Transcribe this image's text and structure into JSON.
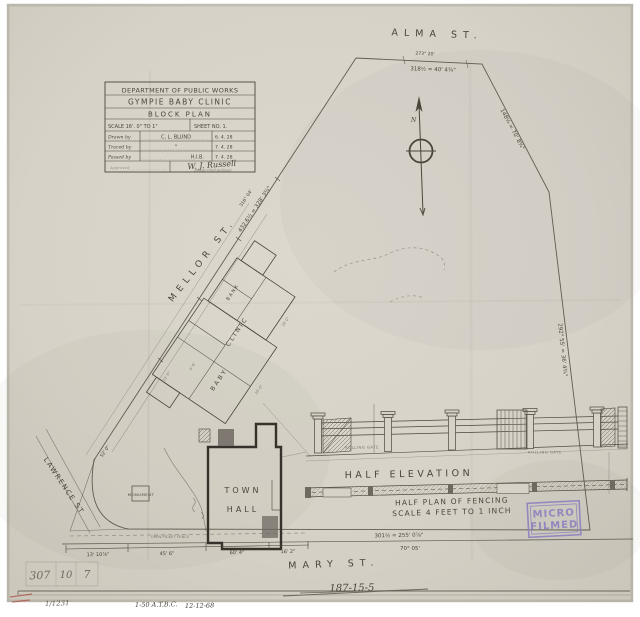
{
  "palette": {
    "paper": "#d7d3c9",
    "ink": "#4b463c",
    "pencil": "#847f74",
    "stamp_purple": "#8a7cc0",
    "red_mark": "#b0574f",
    "blue_pencil": "#7b84a0"
  },
  "title_block": {
    "dept": "DEPARTMENT OF PUBLIC WORKS",
    "project": "GYMPIE  BABY  CLINIC",
    "plan": "BLOCK  PLAN",
    "scale": "SCALE 16'. 0\" TO 1\"",
    "sheet": "SHEET NO. 1.",
    "rows": [
      {
        "label": "Drawn by",
        "value": "C. L. BLUND",
        "date": "6. 4. 28"
      },
      {
        "label": "Traced by",
        "value": "\"",
        "date": "7. 4. 28"
      },
      {
        "label": "Passed by",
        "value": "H.I.B.",
        "date": "7. 4. 28"
      }
    ],
    "approved_label": "Approved",
    "signature": "W. J. Russell",
    "signature_title": "Deputy Chief Architect"
  },
  "streets": {
    "alma": "ALMA  ST.",
    "mellor": "MELLOR  ST.",
    "lawrence": "LAWRENCE  ST",
    "mary": "MARY  ST."
  },
  "labels": {
    "town_1": "TOWN",
    "town_2": "HALL",
    "monument": "MONUMENT",
    "baby": "BABY",
    "clinic": "CLINIC",
    "bank": "BANK",
    "half_elevation": "HALF  ELEVATION",
    "half_plan": "HALF PLAN OF FENCING",
    "half_plan_scale": "SCALE 4 FEET TO 1 INCH",
    "rolling_gate_left": "ROLLING GATE",
    "rolling_gate_right": "ROLLING GATE",
    "north": "N"
  },
  "dimensions": {
    "alma_bearing": "273° 20'",
    "alma_frontage": "318½  =  40' 4¾\"",
    "northeast": "148¼  =  70' 8¾\"",
    "east": "292° 55'  =  36' 4¾\"",
    "mellor_bearing": "316° 04'",
    "mellor_frontage": "432.6½  =  328' 3¾\"",
    "lawrence": "52' 0\"",
    "mary_1": "13' 10⅞\"",
    "mary_2": "45' 6\"",
    "mary_3": "60' 4\"",
    "mary_4": "16' 2\"",
    "mary_frontage": "301½  =  255' 0⅞\"",
    "mary_bearing": "70° 05'",
    "fence_note": "OPEN PICKET FENCE",
    "clinic_1": "25' 0\"",
    "clinic_2": "18' 0\"",
    "clinic_3": "12' 6\"",
    "clinic_4": "9' 6\""
  },
  "stamp": {
    "line1": "MICRO",
    "line2": "FILMED"
  },
  "annotations": {
    "ledger_1": "307",
    "ledger_2": "10",
    "ledger_3": "7",
    "crossed_amount": "187-15-5",
    "file_no": "1/1231",
    "batch": "1-50 A.T.B.C.",
    "date": "12-12-68"
  }
}
